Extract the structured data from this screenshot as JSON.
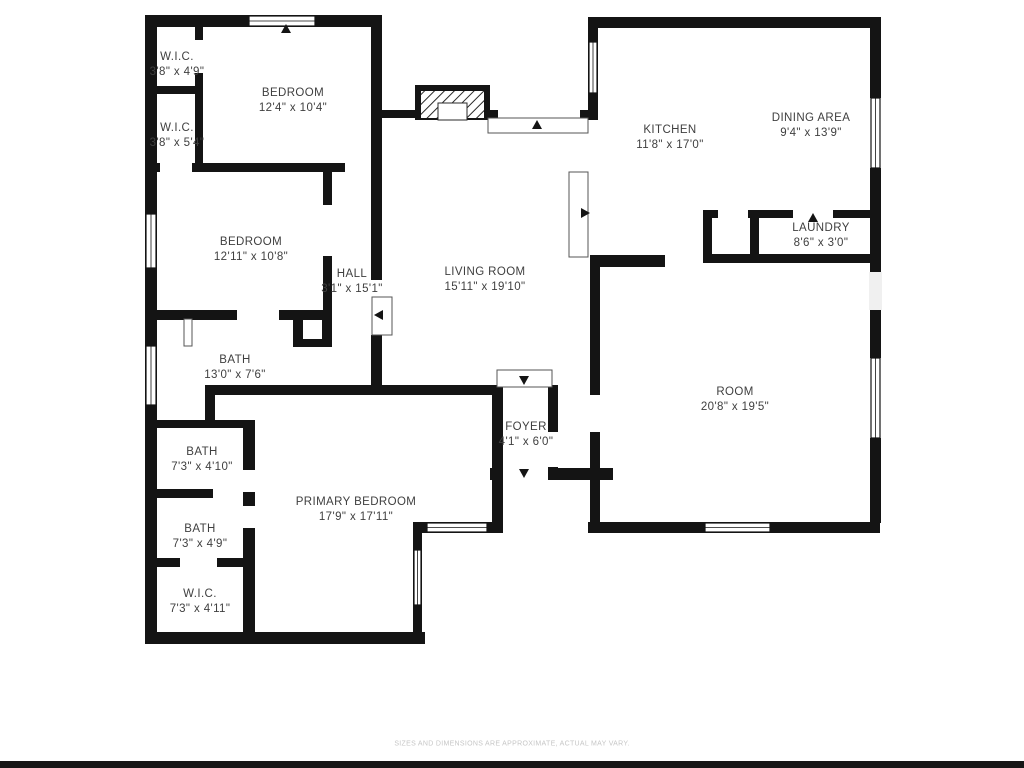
{
  "plan": {
    "rooms": [
      {
        "name": "W.I.C.",
        "dims": "3'8\" x 4'9\""
      },
      {
        "name": "W.I.C.",
        "dims": "3'8\" x 5'4\""
      },
      {
        "name": "BEDROOM",
        "dims": "12'4\" x 10'4\""
      },
      {
        "name": "BEDROOM",
        "dims": "12'11\" x 10'8\""
      },
      {
        "name": "HALL",
        "dims": "3'1\" x 15'1\""
      },
      {
        "name": "LIVING ROOM",
        "dims": "15'11\" x 19'10\""
      },
      {
        "name": "KITCHEN",
        "dims": "11'8\" x 17'0\""
      },
      {
        "name": "DINING AREA",
        "dims": "9'4\" x 13'9\""
      },
      {
        "name": "LAUNDRY",
        "dims": "8'6\" x 3'0\""
      },
      {
        "name": "ROOM",
        "dims": "20'8\" x 19'5\""
      },
      {
        "name": "BATH",
        "dims": "13'0\" x 7'6\""
      },
      {
        "name": "BATH",
        "dims": "7'3\" x 4'10\""
      },
      {
        "name": "BATH",
        "dims": "7'3\" x 4'9\""
      },
      {
        "name": "W.I.C.",
        "dims": "7'3\" x 4'11\""
      },
      {
        "name": "PRIMARY BEDROOM",
        "dims": "17'9\" x 17'11\""
      },
      {
        "name": "FOYER",
        "dims": "4'1\" x 6'0\""
      }
    ],
    "disclaimer": "SIZES AND DIMENSIONS ARE APPROXIMATE, ACTUAL MAY VARY.",
    "colors": {
      "wall": "#141414",
      "label_text": "#3f3f3f",
      "disclaimer_text": "#c6c6c6"
    }
  }
}
